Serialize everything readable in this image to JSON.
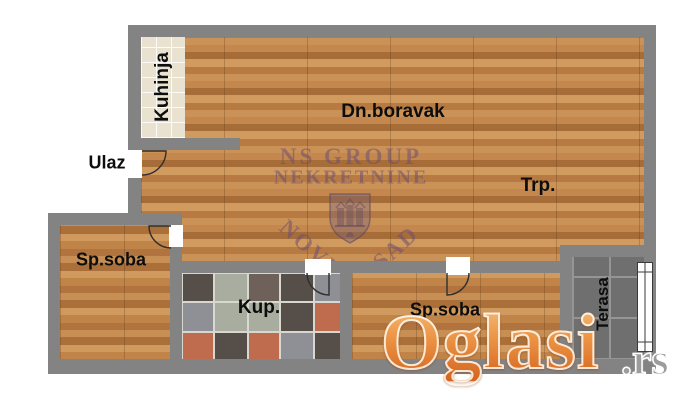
{
  "plan": {
    "rooms": {
      "kitchen": {
        "label": "Kuhinja"
      },
      "entrance": {
        "label": "Ulaz"
      },
      "living_room": {
        "label": "Dn.boravak"
      },
      "dining": {
        "label": "Trp."
      },
      "bedroom_left": {
        "label": "Sp.soba"
      },
      "bathroom": {
        "label": "Kup."
      },
      "bedroom_right": {
        "label": "Sp.soba"
      },
      "terrace": {
        "label": "Terasa"
      }
    },
    "colors": {
      "wall": "#838383",
      "wood_base": "#bd8048",
      "kitchen_tile": "#e9e2d0",
      "terrace_tile": "#6f6f6f",
      "bath_grout": "#d8d8d0",
      "bath_palette": [
        "#564f49",
        "#a9ad9f",
        "#8e9095",
        "#bf6b4e",
        "#6e6159",
        "#bdbfb2",
        "#9b5b4a"
      ],
      "label_text": "#0d0d0d",
      "watermark_purple": "#6d4f73",
      "oglasi_orange": "#e0813a"
    },
    "icons": {
      "doors": "door-swing-icon",
      "window": "window-icon",
      "emblem": "novi-sad-coat-of-arms-icon"
    }
  },
  "watermarks": {
    "agency": {
      "name_line1": "NS GROUP",
      "name_line2": "NEKRETNINE",
      "city_word1": "NOVI",
      "city_word2": "SAD"
    },
    "portal": {
      "brand": "Oglasi",
      "tld": ".rs"
    }
  }
}
